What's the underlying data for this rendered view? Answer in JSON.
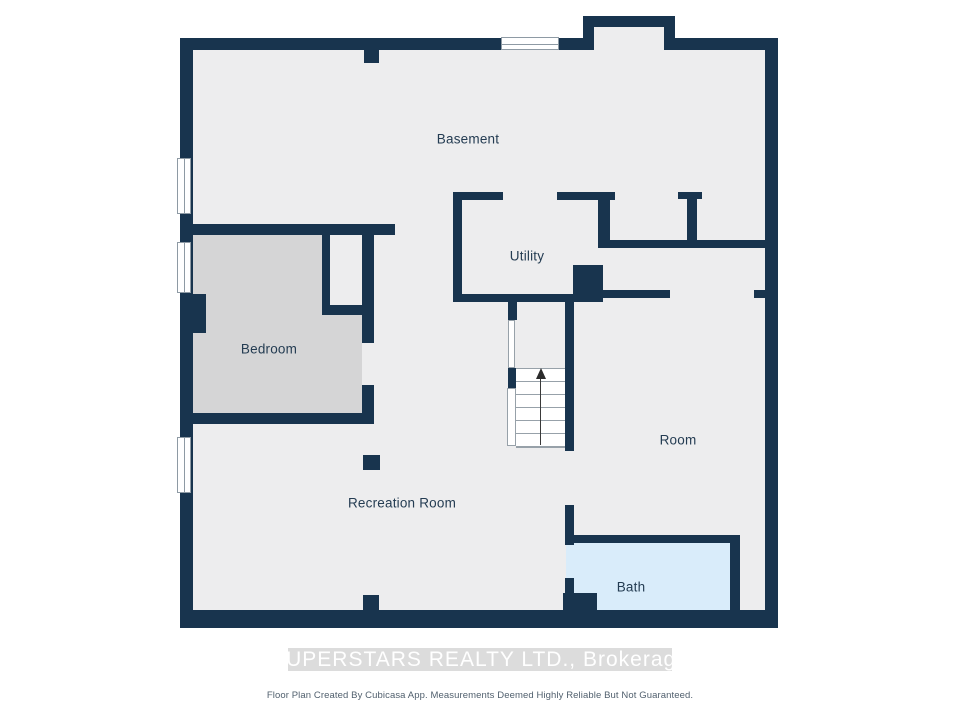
{
  "plan": {
    "title_rooms": {
      "basement": {
        "label": "Basement"
      },
      "utility": {
        "label": "Utility"
      },
      "bedroom": {
        "label": "Bedroom"
      },
      "room": {
        "label": "Room"
      },
      "recreation": {
        "label": "Recreation Room"
      },
      "bath": {
        "label": "Bath"
      }
    },
    "stairs": {
      "direction": "up"
    }
  },
  "watermark": {
    "text": "SUPERSTARS REALTY LTD., Brokerage"
  },
  "footer": {
    "text": "Floor Plan Created By Cubicasa App. Measurements Deemed Highly Reliable But Not Guaranteed."
  },
  "colors": {
    "wall": "#18344E",
    "floor": "#EDEDEE",
    "bedroom_floor": "#D5D5D6",
    "bath_floor": "#D9ECFA",
    "label": "#243C52",
    "watermark_band": "#DCDCDC",
    "watermark_text": "#FFFFFF",
    "footer_text": "#51606E",
    "window": "#FFFFFF"
  }
}
